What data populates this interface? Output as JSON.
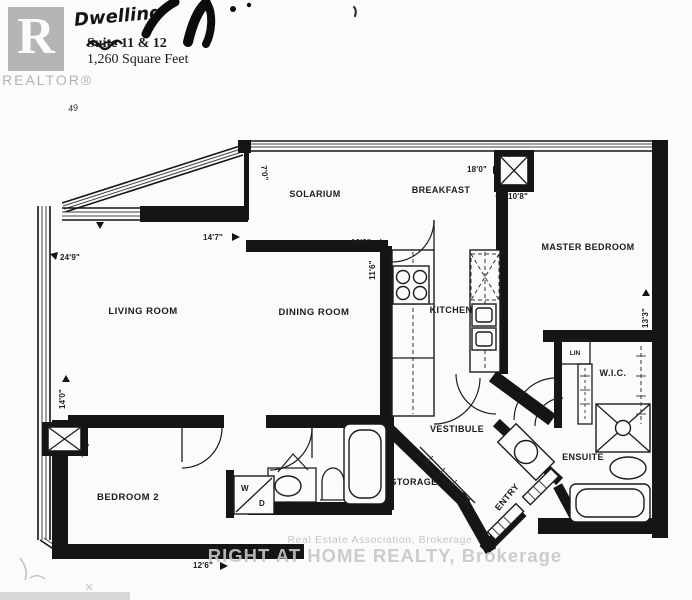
{
  "header": {
    "logo_letter": "R",
    "logo_caption": "REALTOR®",
    "title": "Dwelling",
    "suite": "Suite 11 & 12",
    "area": "1,260 Square Feet",
    "note": "49"
  },
  "rooms": {
    "solarium": "SOLARIUM",
    "breakfast": "BREAKFAST",
    "master_bedroom": "MASTER BEDROOM",
    "living_room": "LIVING ROOM",
    "dining_room": "DINING ROOM",
    "kitchen": "KITCHEN",
    "lin": "LIN",
    "wic": "W.I.C.",
    "vestibule": "VESTIBULE",
    "ensuite": "ENSUITE",
    "entry": "ENTRY",
    "storage": "STORAGE",
    "bedroom2": "BEDROOM 2",
    "washer": "W",
    "dryer": "D"
  },
  "dimensions": {
    "solarium_depth": "7'0\"",
    "living_width": "14'7\"",
    "solarium_width": "10'0\"",
    "kitchen_depth": "11'6\"",
    "breakfast_width": "18'0\"",
    "master_width": "10'8\"",
    "living_depth": "24'9\"",
    "master_depth": "13'3\"",
    "bedroom2_depth": "14'0\"",
    "bedroom2_nook": "10'6\"",
    "bedroom2_width": "12'6\""
  },
  "watermark": {
    "line1": "Real Estate Association, Brokerage",
    "line2": "RIGHT AT HOME REALTY, Brokerage"
  },
  "colors": {
    "paper": "#fbfbf9",
    "ink": "#151515",
    "logo_gray": "#b5b5b5",
    "watermark_gray": "#c7c7c7"
  }
}
